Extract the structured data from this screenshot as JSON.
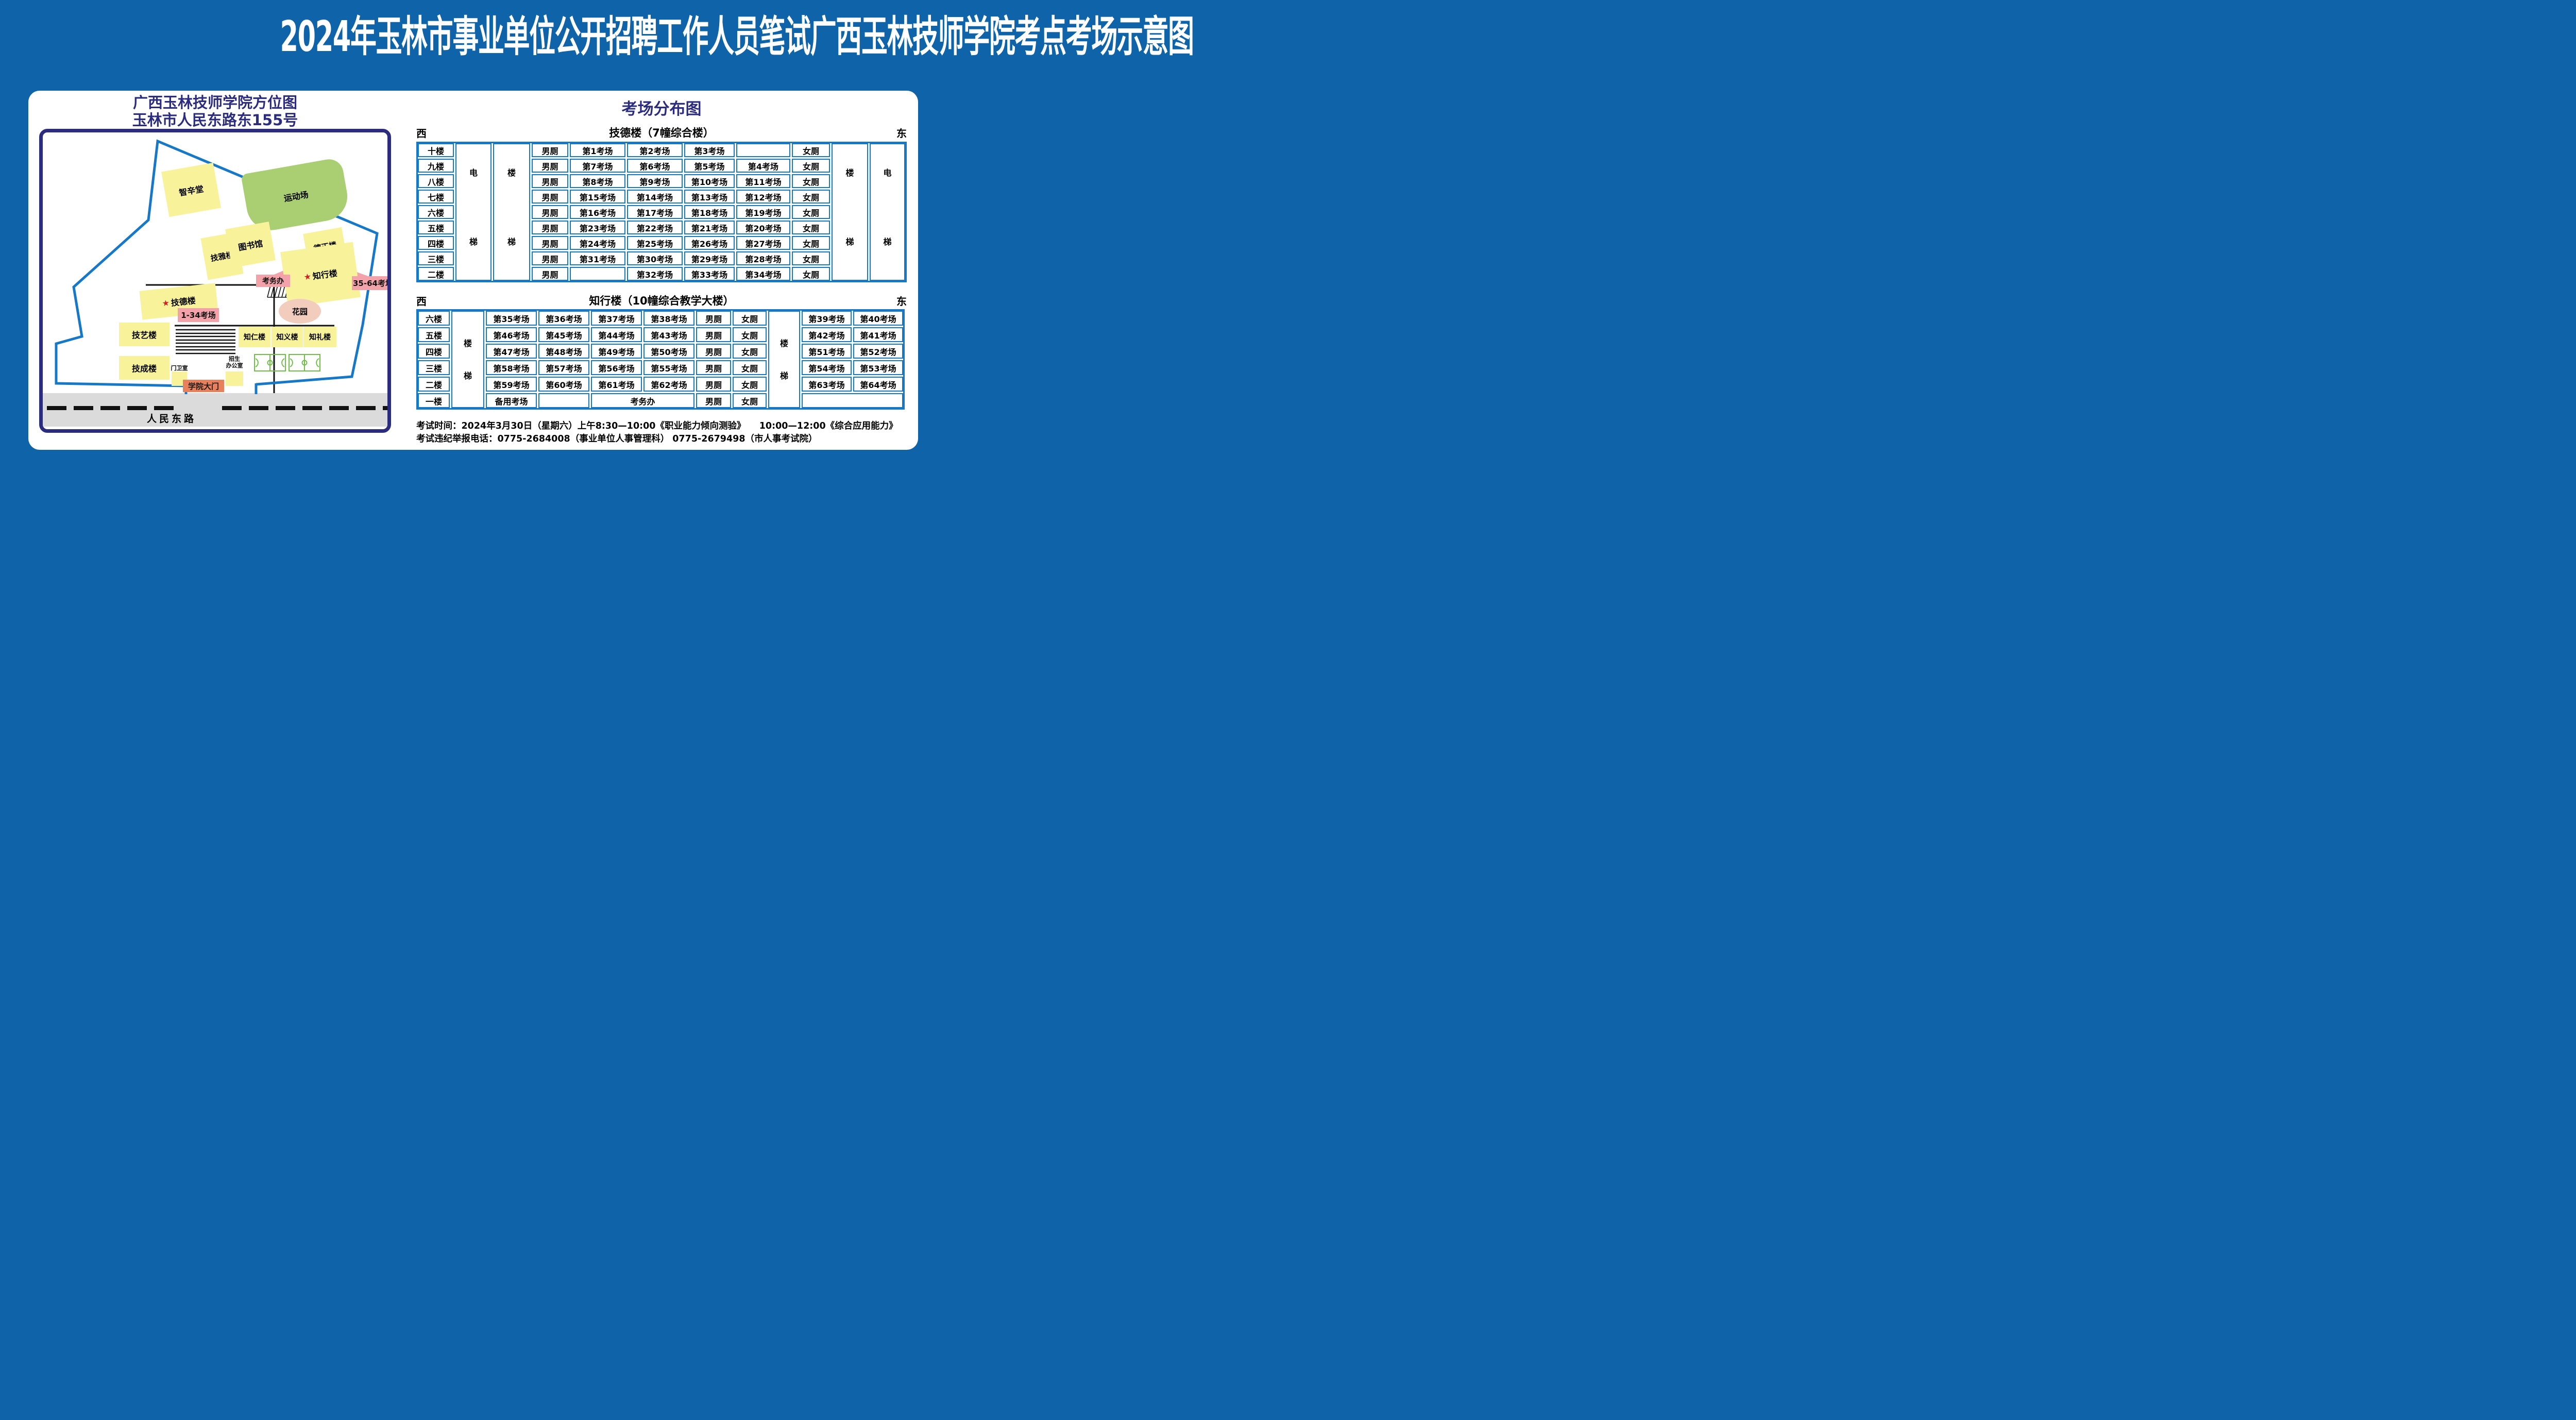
{
  "page_title": "2024年玉林市事业单位公开招聘工作人员笔试广西玉林技师学院考点考场示意图",
  "map": {
    "title_line1": "广西玉林技师学院方位图",
    "title_line2": "玉林市人民东路东155号",
    "star_icon": "★",
    "buildings": {
      "zhixintang": "智辛堂",
      "yundongchang": "运动场",
      "jiyalou": "技雅楼",
      "tushuguan": "图书馆",
      "dezhenglou": "德正楼",
      "zhixinglou": "知行楼",
      "jidelou": "技德楼",
      "huayuan": "花园",
      "jiyilou": "技艺楼",
      "zhirenlou": "知仁楼",
      "zhiyilou": "知义楼",
      "zhililou": "知礼楼",
      "jichenglou": "技成楼",
      "menweishi": "门卫室",
      "zhaosheng_line1": "招生",
      "zhaosheng_line2": "办公室"
    },
    "callouts": {
      "exam_office": "考务办",
      "rooms_35_64": "35-64考场",
      "rooms_1_34": "1-34考场"
    },
    "gate_label": "学院大门",
    "road_label": "人民东路"
  },
  "distribution": {
    "title": "考场分布图",
    "west_label": "西",
    "east_label": "东",
    "male_label": "男厕",
    "female_label": "女厕",
    "elevator_chars": [
      "电",
      "梯"
    ],
    "stairs_chars": [
      "楼",
      "梯"
    ],
    "building1": {
      "title": "技德楼（7幢综合楼）",
      "floors": [
        {
          "floor": "十楼",
          "rooms": [
            "第1考场",
            "第2考场",
            "第3考场",
            ""
          ]
        },
        {
          "floor": "九楼",
          "rooms": [
            "第7考场",
            "第6考场",
            "第5考场",
            "第4考场"
          ]
        },
        {
          "floor": "八楼",
          "rooms": [
            "第8考场",
            "第9考场",
            "第10考场",
            "第11考场"
          ]
        },
        {
          "floor": "七楼",
          "rooms": [
            "第15考场",
            "第14考场",
            "第13考场",
            "第12考场"
          ]
        },
        {
          "floor": "六楼",
          "rooms": [
            "第16考场",
            "第17考场",
            "第18考场",
            "第19考场"
          ]
        },
        {
          "floor": "五楼",
          "rooms": [
            "第23考场",
            "第22考场",
            "第21考场",
            "第20考场"
          ]
        },
        {
          "floor": "四楼",
          "rooms": [
            "第24考场",
            "第25考场",
            "第26考场",
            "第27考场"
          ]
        },
        {
          "floor": "三楼",
          "rooms": [
            "第31考场",
            "第30考场",
            "第29考场",
            "第28考场"
          ]
        },
        {
          "floor": "二楼",
          "rooms": [
            "",
            "第32考场",
            "第33考场",
            "第34考场"
          ]
        }
      ]
    },
    "building2": {
      "title": "知行楼（10幢综合教学大楼）",
      "floors": [
        {
          "floor": "六楼",
          "west": [
            "第35考场",
            "第36考场",
            "第37考场",
            "第38考场"
          ],
          "east": [
            "第39考场",
            "第40考场"
          ]
        },
        {
          "floor": "五楼",
          "west": [
            "第46考场",
            "第45考场",
            "第44考场",
            "第43考场"
          ],
          "east": [
            "第42考场",
            "第41考场"
          ]
        },
        {
          "floor": "四楼",
          "west": [
            "第47考场",
            "第48考场",
            "第49考场",
            "第50考场"
          ],
          "east": [
            "第51考场",
            "第52考场"
          ]
        },
        {
          "floor": "三楼",
          "west": [
            "第58考场",
            "第57考场",
            "第56考场",
            "第55考场"
          ],
          "east": [
            "第54考场",
            "第53考场"
          ]
        },
        {
          "floor": "二楼",
          "west": [
            "第59考场",
            "第60考场",
            "第61考场",
            "第62考场"
          ],
          "east": [
            "第63考场",
            "第64考场"
          ]
        }
      ],
      "ground": {
        "floor": "一楼",
        "backup": "备用考场",
        "office": "考务办"
      }
    }
  },
  "notes": {
    "line1": "考试时间：2024年3月30日（星期六）上午8:30—10:00《职业能力倾向测验》　　10:00—12:00《综合应用能力》",
    "line2": "考试违纪举报电话：0775-2684008（事业单位人事管理科） 0775-2679498（市人事考试院）"
  },
  "colors": {
    "background_blue": "#0E63A9",
    "navy": "#2B2C7D",
    "table_blue": "#1779C6",
    "building_yellow": "#F8F29A",
    "field_green": "#A9CF72",
    "callout_pink": "#F2A2A8",
    "garden_pink": "#F2CCBD",
    "gate_orange": "#E8805C",
    "road_gray": "#DBDBDB",
    "star_red": "#D21F26"
  }
}
